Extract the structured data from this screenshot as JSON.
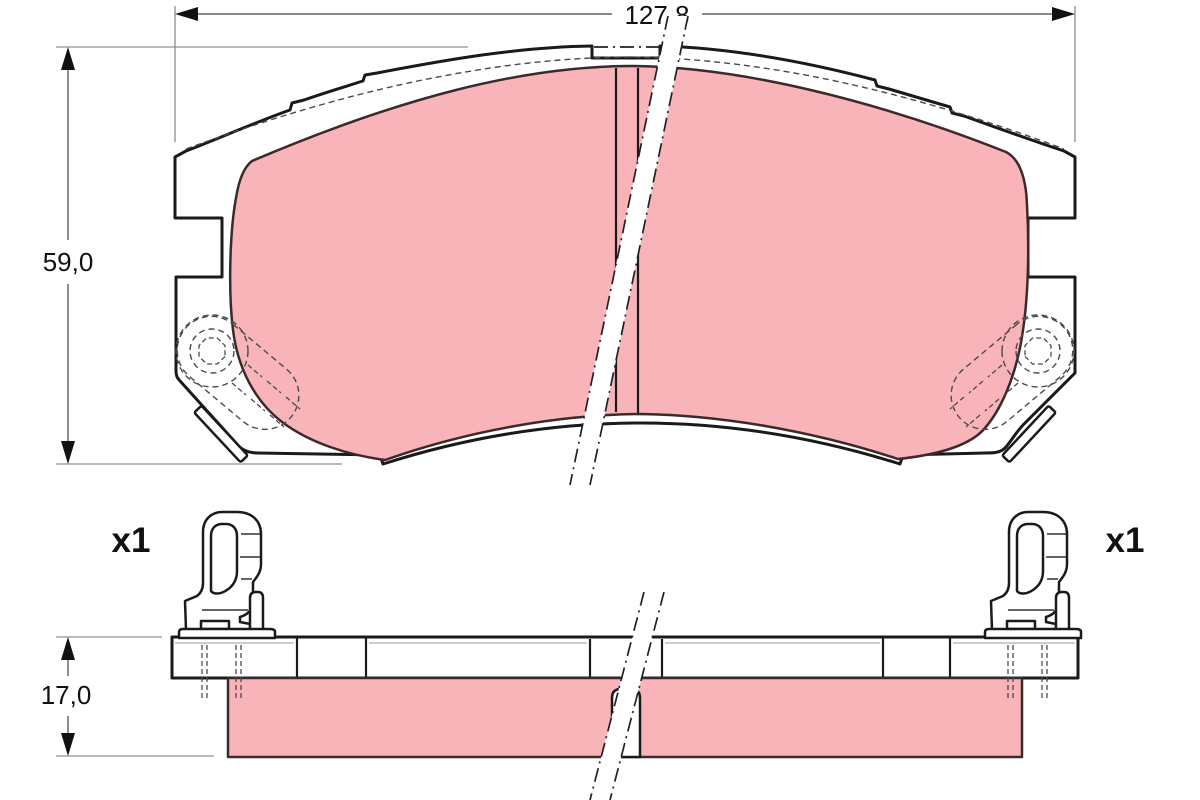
{
  "drawing": {
    "type": "brake-pad-technical-drawing",
    "front_view": {
      "width_label": "127,8",
      "height_label": "59,0"
    },
    "side_view": {
      "thickness_label": "17,0"
    },
    "quantity_labels": {
      "left": "x1",
      "right": "x1"
    },
    "colors": {
      "friction_material": "#f8b4b9",
      "outline": "#1a1a1a",
      "dimension_lines": "#444444"
    }
  }
}
